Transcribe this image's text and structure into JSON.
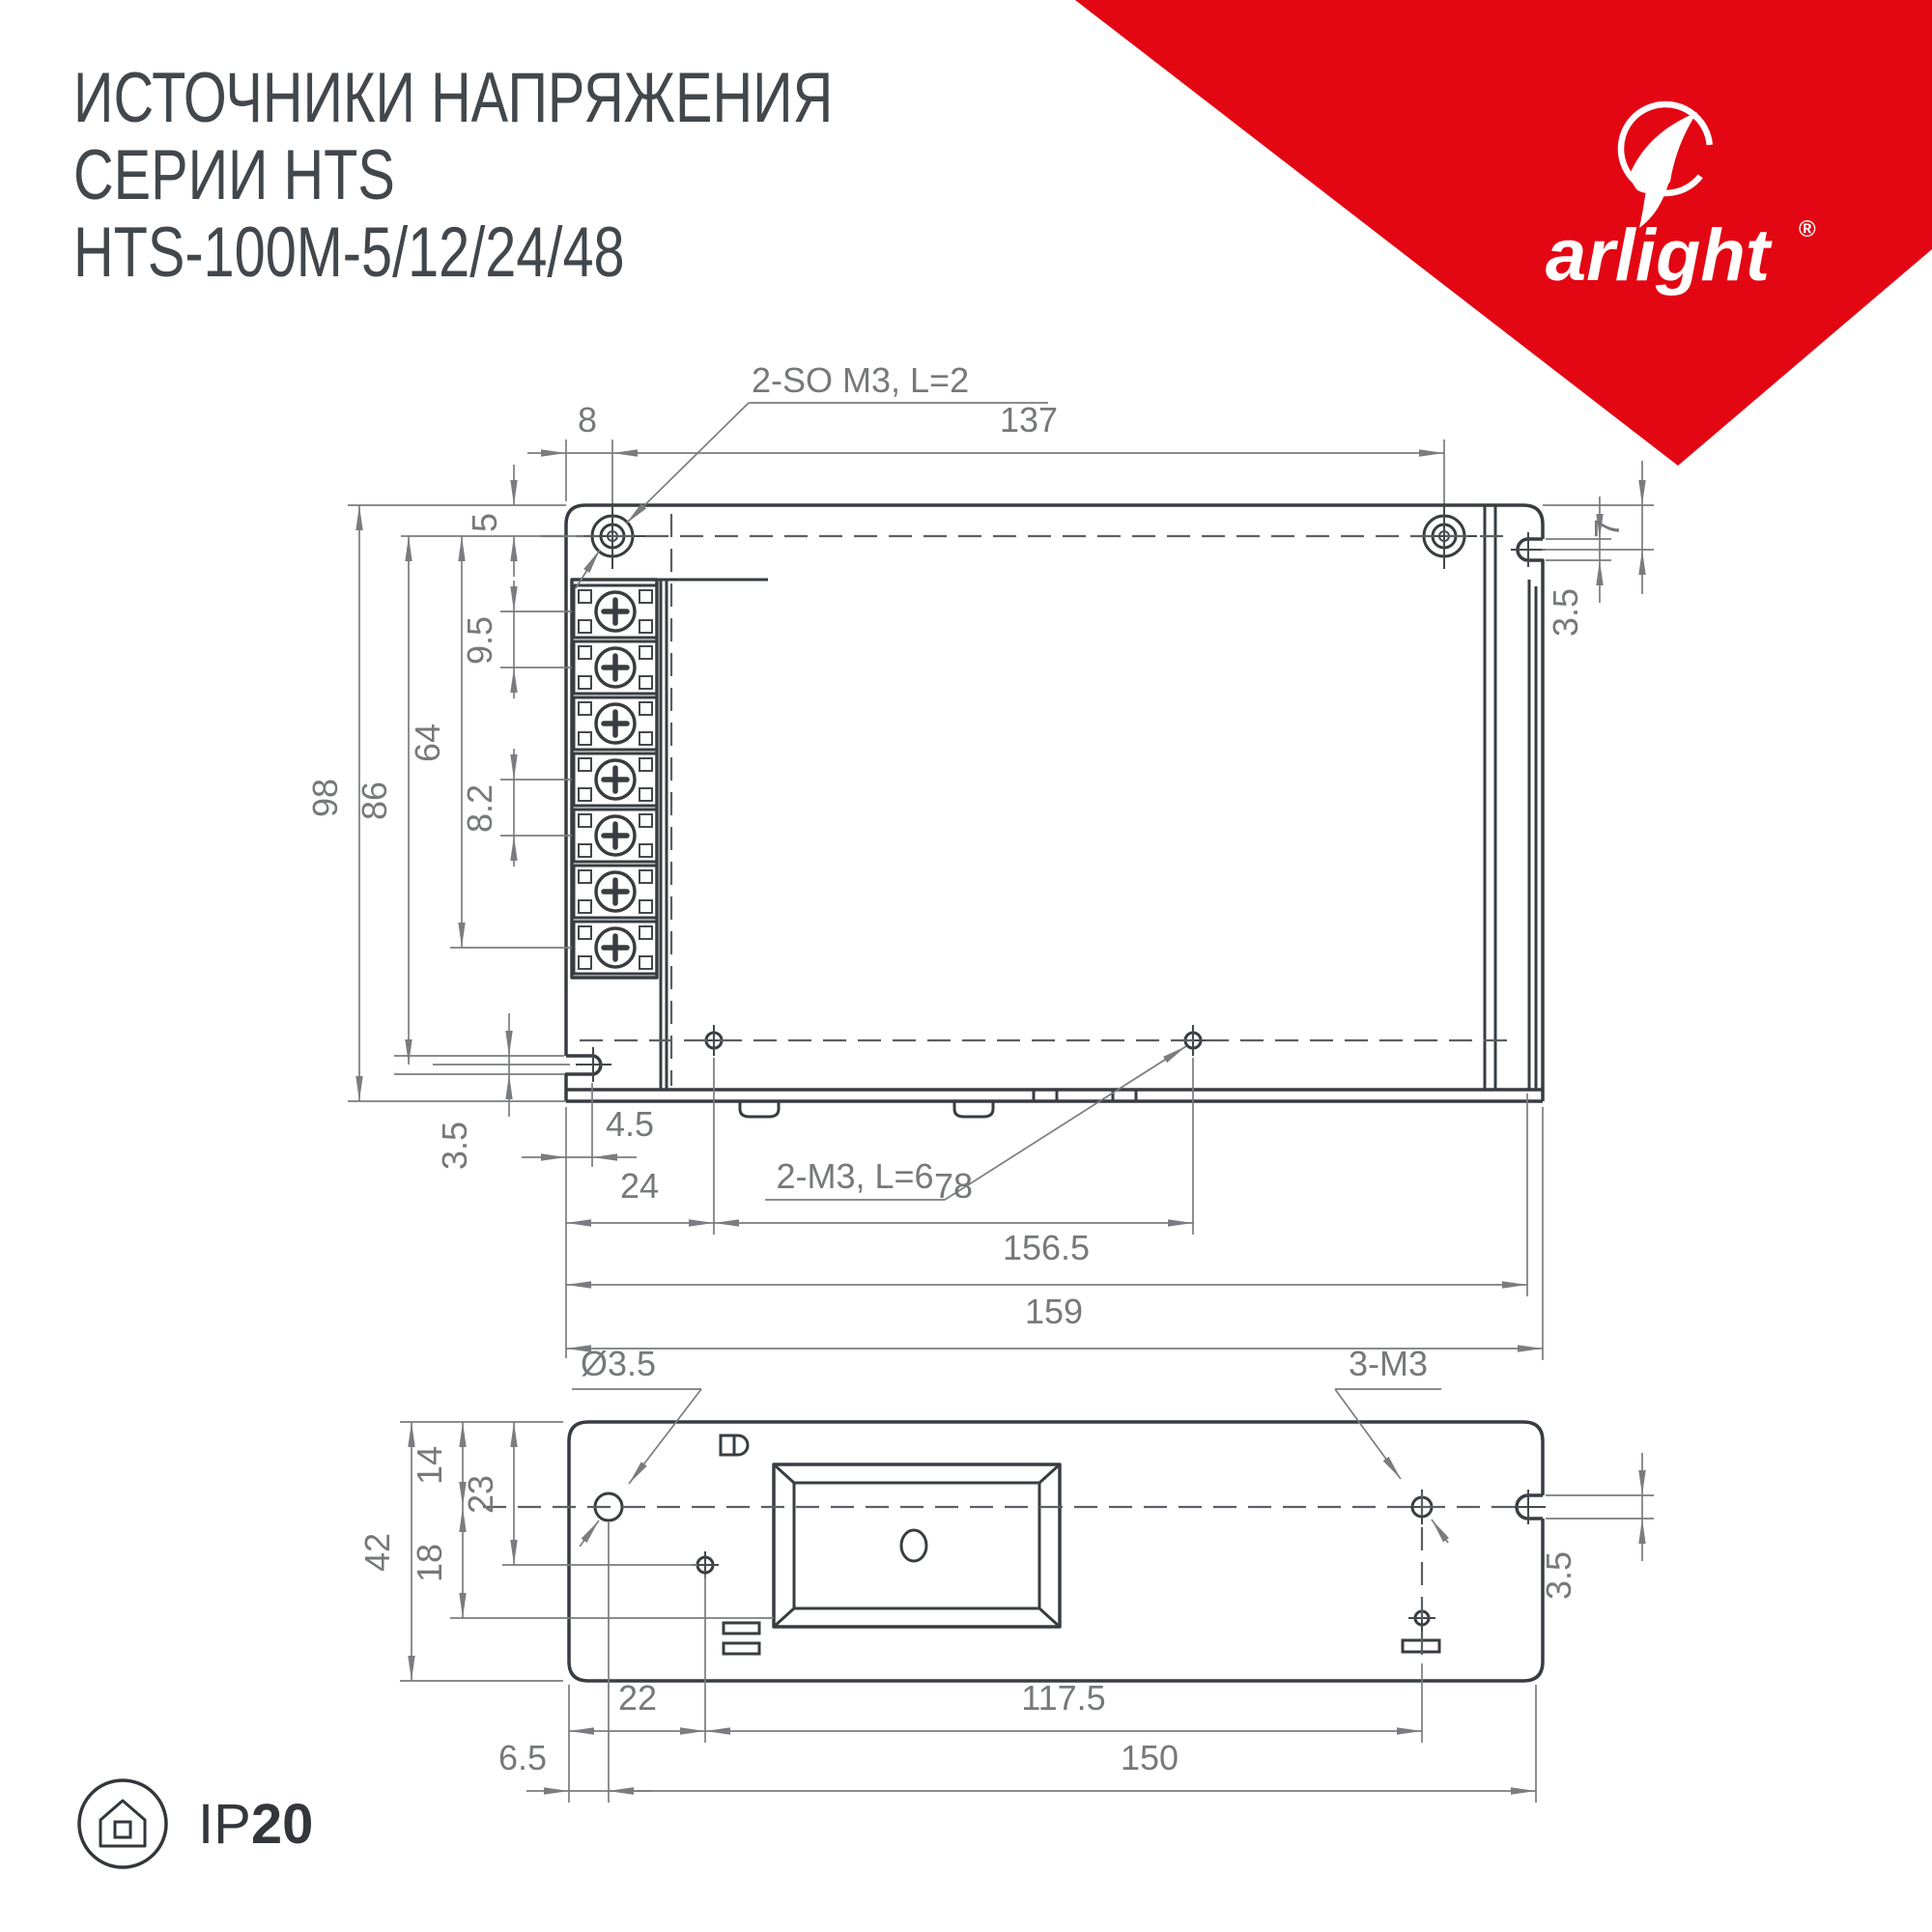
{
  "title": {
    "line1": "ИСТОЧНИКИ НАПРЯЖЕНИЯ",
    "line2": "СЕРИИ HTS",
    "line3": "HTS-100M-5/12/24/48"
  },
  "brand": {
    "name": "arlight",
    "registered": "®",
    "accent_color": "#e30613"
  },
  "badge": {
    "ip_prefix": "IP",
    "ip_rating": "20"
  },
  "colors": {
    "outline_dark": "#393d41",
    "dimension_gray": "#7a7c7f",
    "background": "#ffffff"
  },
  "top_view": {
    "callouts": {
      "mount_holes": "2-SO M3, L=2",
      "base_screws": "2-M3, L=6"
    },
    "dims": {
      "d8": "8",
      "d137": "137",
      "d5": "5",
      "d98": "98",
      "d86": "86",
      "d64": "64",
      "d9_5": "9.5",
      "d8_2": "8.2",
      "d7": "7",
      "d3_5_right": "3.5",
      "d3_5_left": "3.5",
      "d4_5": "4.5",
      "d24": "24",
      "d78": "78",
      "d156_5": "156.5",
      "d159": "159"
    }
  },
  "bottom_view": {
    "callouts": {
      "hole_dia": "Ø3.5",
      "side_screws": "3-M3"
    },
    "dims": {
      "d42": "42",
      "d14": "14",
      "d23": "23",
      "d18": "18",
      "d3_5": "3.5",
      "d22": "22",
      "d117_5": "117.5",
      "d6_5": "6.5",
      "d150": "150"
    }
  }
}
